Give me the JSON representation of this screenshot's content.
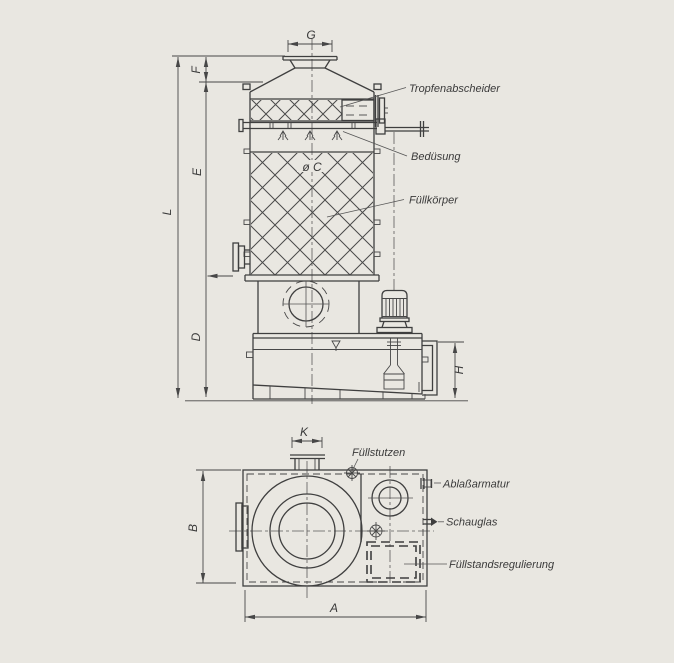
{
  "page": {
    "kind": "technical-drawing-scan",
    "paper_color": "#e9e7e1",
    "ink_color": "#3f3f3f"
  },
  "front_view": {
    "callouts": {
      "tropfenabscheider": "Tropfenabscheider",
      "beduesung": "Bedüsung",
      "fuellkoerper": "Füllkörper"
    },
    "dimensions": {
      "G": "G",
      "F": "F",
      "E": "E",
      "L": "L",
      "D": "D",
      "H": "H",
      "diameter_c": "ø C"
    }
  },
  "plan_view": {
    "callouts": {
      "fuellstutzen": "Füllstutzen",
      "ablassarmatur": "Ablaßarmatur",
      "schauglas": "Schauglas",
      "fuellstandsregulierung": "Füllstandsregulierung"
    },
    "dimensions": {
      "K": "K",
      "B": "B",
      "A": "A"
    }
  }
}
